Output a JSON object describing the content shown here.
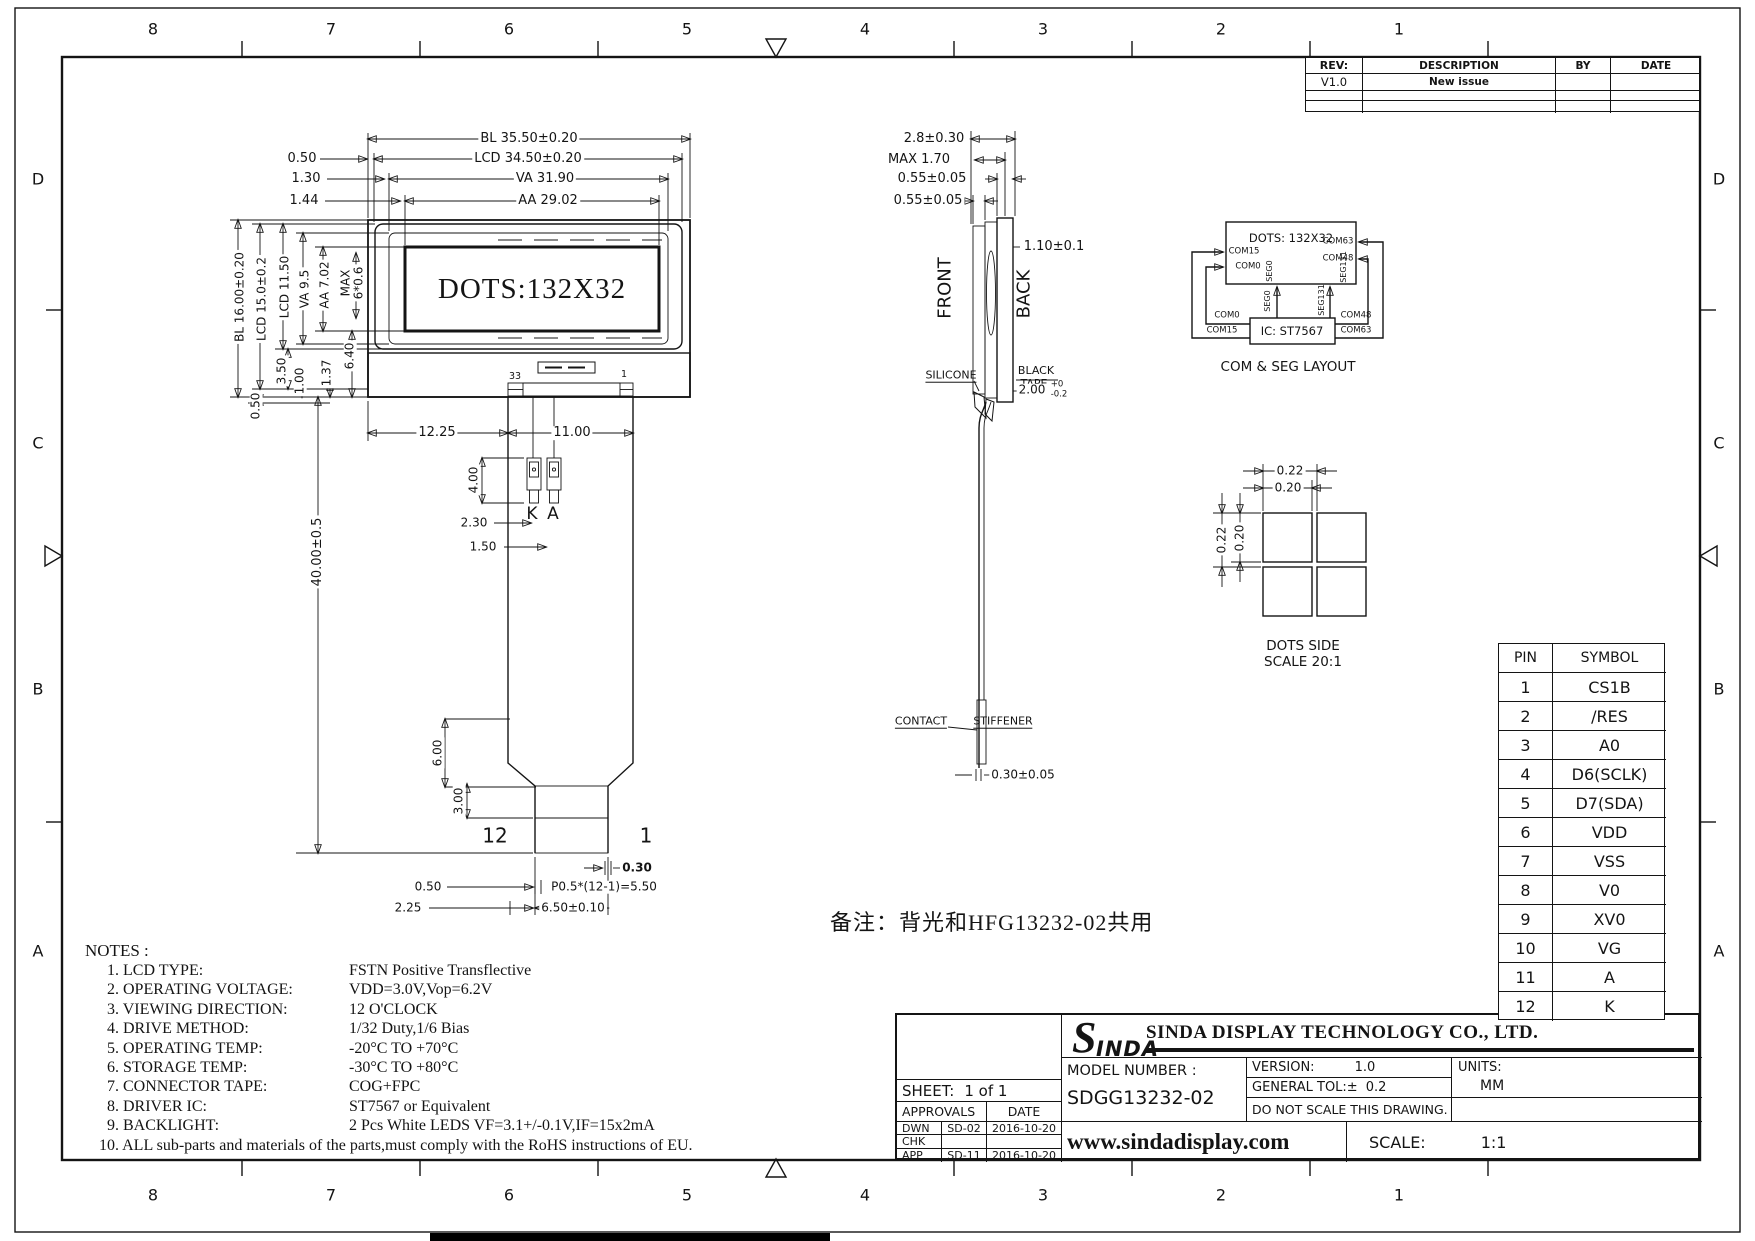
{
  "colors": {
    "line": "#141414",
    "paper": "#ffffff"
  },
  "zones": {
    "columns": [
      "8",
      "7",
      "6",
      "5",
      "4",
      "3",
      "2",
      "1"
    ],
    "rows": [
      "D",
      "C",
      "B",
      "A"
    ]
  },
  "revision_table": {
    "headers": {
      "rev": "REV:",
      "description": "DESCRIPTION",
      "by": "BY",
      "date": "DATE"
    },
    "rows": [
      {
        "rev": "V1.0",
        "description": "New issue",
        "by": "",
        "date": ""
      }
    ]
  },
  "front_view": {
    "display_text": "DOTS:132X32",
    "dim_bl_w": "BL  35.50±0.20",
    "dim_lcd_w": "LCD  34.50±0.20",
    "dim_va_w": "VA  31.90",
    "dim_aa_w": "AA  29.02",
    "off_050": "0.50",
    "off_130": "1.30",
    "off_144": "1.44",
    "dim_bl_h": "BL  16.00±0.20",
    "dim_lcd_h": "LCD  15.0±0.2",
    "dim_lcd2_h": "LCD  11.50",
    "dim_va_h": "VA  9.5",
    "dim_aa_h": "AA  7.02",
    "dim_max_1": "MAX",
    "dim_max_2": "6*0.6",
    "d_350": "3.50",
    "d_100": "1.00",
    "d_137": "1.37",
    "d_640": "6.40",
    "d_050_side": "0.50",
    "cog_pin_left": "33",
    "cog_pin_right": "1",
    "d_1225": "12.25",
    "d_1100": "11.00",
    "d_4000": "40.00±0.5",
    "d_400": "4.00",
    "d_230": "2.30",
    "d_150": "1.50",
    "led_k": "K",
    "led_a": "A",
    "d_600": "6.00",
    "d_300": "3.00",
    "fpc_pin_left": "12",
    "fpc_pin_right": "1",
    "d_030": "0.30",
    "d_050_pitch": "0.50",
    "pitch_formula": "P0.5*(12-1)=5.50",
    "d_225": "2.25",
    "d_650": "6.50±0.10"
  },
  "side_view": {
    "d_28": "2.8±0.30",
    "d_max170": "MAX  1.70",
    "d_055_a": "0.55±0.05",
    "d_055_b": "0.55±0.05",
    "d_110": "1.10±0.1",
    "front_label": "FRONT",
    "back_label": "BACK",
    "silicone": "SILICONE",
    "black_tape_1": "BLACK",
    "black_tape_2": "TAPE",
    "d_200": "2.00",
    "d_200_up": "+0",
    "d_200_dn": "-0.2",
    "contact": "CONTACT",
    "stiffener": "STIFFENER",
    "d_030": "0.30±0.05"
  },
  "com_seg": {
    "box_title": "DOTS: 132X32",
    "com15": "COM15",
    "com0": "COM0",
    "com63": "COM63",
    "com48": "COM48",
    "seg0": "SEG0",
    "seg131": "SEG131",
    "ic_label": "IC: ST7567",
    "wire_com0": "COM0",
    "wire_com15": "COM15",
    "wire_com48": "COM48",
    "wire_com63": "COM63",
    "wire_seg0": "SEG0",
    "wire_seg131": "SEG131",
    "caption": "COM & SEG LAYOUT"
  },
  "dots_side": {
    "d_022_h": "0.22",
    "d_020_h": "0.20",
    "d_022_v": "0.22",
    "d_020_v": "0.20",
    "caption_1": "DOTS SIDE",
    "caption_2": "SCALE 20:1"
  },
  "pin_table": {
    "headers": {
      "pin": "PIN",
      "symbol": "SYMBOL"
    },
    "rows": [
      {
        "pin": "1",
        "symbol": "CS1B"
      },
      {
        "pin": "2",
        "symbol": "/RES"
      },
      {
        "pin": "3",
        "symbol": "A0"
      },
      {
        "pin": "4",
        "symbol": "D6(SCLK)"
      },
      {
        "pin": "5",
        "symbol": "D7(SDA)"
      },
      {
        "pin": "6",
        "symbol": "VDD"
      },
      {
        "pin": "7",
        "symbol": "VSS"
      },
      {
        "pin": "8",
        "symbol": "V0"
      },
      {
        "pin": "9",
        "symbol": "XV0"
      },
      {
        "pin": "10",
        "symbol": "VG"
      },
      {
        "pin": "11",
        "symbol": "A"
      },
      {
        "pin": "12",
        "symbol": "K"
      }
    ]
  },
  "remark": "备注：背光和HFG13232-02共用",
  "notes": {
    "title": "NOTES :",
    "items": [
      {
        "label": "1. LCD TYPE:",
        "value": "FSTN   Positive Transflective"
      },
      {
        "label": "2. OPERATING VOLTAGE:",
        "value": "VDD=3.0V,Vop=6.2V"
      },
      {
        "label": "3. VIEWING DIRECTION:",
        "value": "12 O'CLOCK"
      },
      {
        "label": "4. DRIVE METHOD:",
        "value": "1/32 Duty,1/6 Bias"
      },
      {
        "label": "5. OPERATING TEMP:",
        "value": "-20°C TO +70°C"
      },
      {
        "label": "6. STORAGE TEMP:",
        "value": "-30°C TO +80°C"
      },
      {
        "label": "7. CONNECTOR TAPE:",
        "value": "COG+FPC"
      },
      {
        "label": "8. DRIVER IC:",
        "value": "ST7567 or Equivalent"
      },
      {
        "label": "9. BACKLIGHT:",
        "value": "2 Pcs White LEDS VF=3.1+/-0.1V,IF=15x2mA"
      },
      {
        "label": "10. ALL sub-parts and materials of the parts,must comply with the RoHS instructions of EU.",
        "value": ""
      }
    ]
  },
  "title_block": {
    "sheet_label": "SHEET:",
    "sheet_value": "1  of  1",
    "approvals": "APPROVALS",
    "date": "DATE",
    "dwn": "DWN",
    "dwn_by": "SD-02",
    "dwn_date": "2016-10-20",
    "chk": "CHK",
    "app": "APP",
    "app_by": "SD-11",
    "app_date": "2016-10-20",
    "logo_s": "S",
    "logo_rest": "INDA",
    "company": "SINDA DISPLAY  TECHNOLOGY  CO., LTD.",
    "model_label": "MODEL  NUMBER  :",
    "model_value": "SDGG13232-02",
    "version_label": "VERSION:",
    "version_value": "1.0",
    "tol_label": "GENERAL  TOL:±",
    "tol_value": "0.2",
    "units_label": "UNITS:",
    "units_value": "MM",
    "no_scale": "DO  NOT  SCALE  THIS  DRAWING.",
    "website": "www.sindadisplay.com",
    "scale_label": "SCALE:",
    "scale_value": "1:1"
  }
}
